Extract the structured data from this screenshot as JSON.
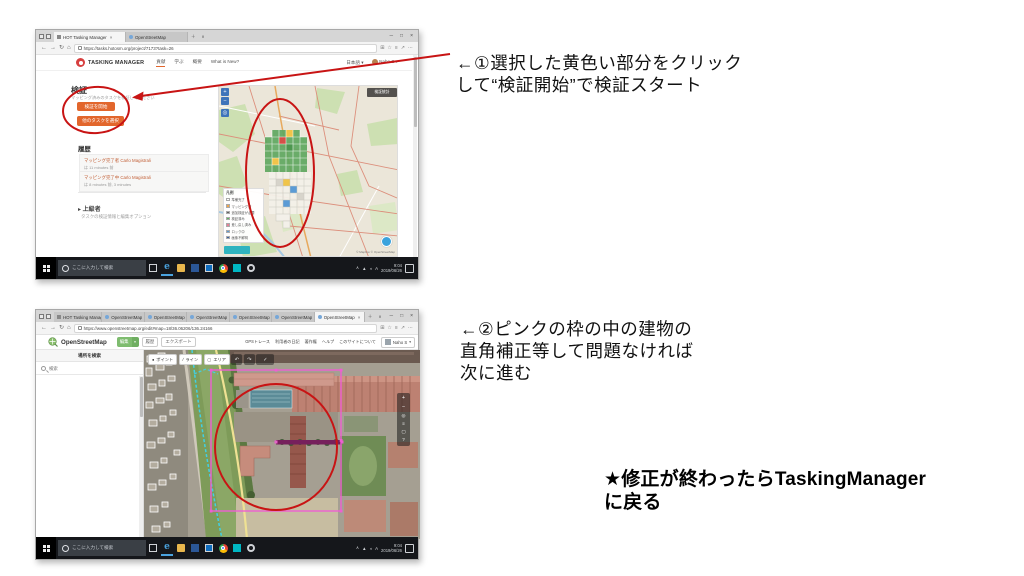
{
  "annotations": {
    "note1_line1": "←①選択した黄色い部分をクリック",
    "note1_line2": "して“検証開始”で検証スタート",
    "note2_line1": "←②ピンクの枠の中の建物の",
    "note2_line2": "直角補正等して問題なければ",
    "note2_line3": "次に進む",
    "note3_line1": "★修正が終わったらTaskingManager",
    "note3_line2": "に戻る"
  },
  "win_top": {
    "tabs": [
      {
        "label": "HOT Tasking Manager"
      },
      {
        "label": "OpenStreetMap"
      }
    ],
    "url": "https://tasks.hotosm.org/project/7173?task=26",
    "header": {
      "brand": "TASKING MANAGER",
      "nav": [
        "貢献",
        "学ぶ",
        "概要",
        "What is New?"
      ],
      "lang": "日本語",
      "user": "Naho S"
    },
    "panel": {
      "title": "検証",
      "subtitle": "マッピング済みのタスクを検証してください",
      "start_button": "検証を開始",
      "other_button": "他のタスクを選択",
      "history_title": "履歴",
      "history": [
        {
          "text": "マッピング完了者 Carlo Magistrali",
          "meta": "は 11 minutes 前"
        },
        {
          "text": "マッピング完了中 Carlo Magistrali",
          "meta": "は 8 minutes 前, 3 minutes"
        }
      ],
      "advanced": "▸ 上級者",
      "advanced_sub": "タスクの検証情報と編集オプション"
    },
    "map": {
      "stats_button": "検証統計",
      "legend_title": "凡例",
      "legend": [
        {
          "label": "準備完了",
          "color": "#ffffff"
        },
        {
          "label": "マッピング済",
          "color": "#f0a64c"
        },
        {
          "label": "追加検証が必要",
          "color": "#616161"
        },
        {
          "label": "検証済み",
          "color": "#5cb85c"
        },
        {
          "label": "差し戻し済み",
          "color": "#e87e95"
        },
        {
          "label": "ロック中",
          "color": "#5a9bd4"
        },
        {
          "label": "画像不鮮明",
          "color": "#3a5f9e"
        }
      ],
      "attribution": "© Mapbox © OpenStreetMap"
    }
  },
  "win_bottom": {
    "tabs": [
      {
        "label": "HOT Tasking Manage"
      },
      {
        "label": "OpenStreetMap"
      },
      {
        "label": "OpenStreetMap"
      },
      {
        "label": "OpenStreetMap"
      },
      {
        "label": "OpenStreetMap"
      },
      {
        "label": "OpenStreetMap"
      },
      {
        "label": "OpenStreetMap"
      }
    ],
    "url": "https://www.openstreetmap.org/edit#map=18/36.06206/136.24166",
    "osm": {
      "brand": "OpenStreetMap",
      "edit_button": "編集",
      "history_button": "履歴",
      "export_button": "エクスポート",
      "nav": [
        "GPSトレース",
        "利用者の日記",
        "著作権",
        "ヘルプ",
        "このサイトについて"
      ],
      "user": "Naho S",
      "sidebar_title": "場所を検索",
      "search_placeholder": "検索",
      "toolbar": [
        {
          "label": "ポイント"
        },
        {
          "label": "ライン"
        },
        {
          "label": "エリア"
        }
      ]
    }
  },
  "taskbar": {
    "search_placeholder": "ここに入力して検索",
    "ime": "A",
    "time": "9:04",
    "date": "2019/06/26"
  }
}
